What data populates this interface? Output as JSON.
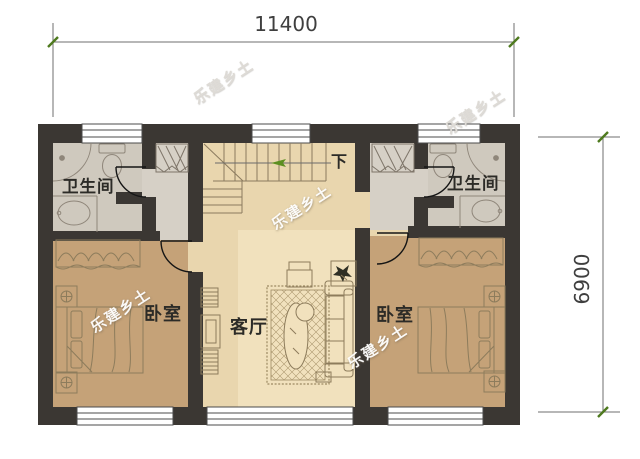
{
  "canvas": {
    "width": 640,
    "height": 459,
    "background": "#ffffff"
  },
  "dimensions": {
    "width_label": "11400",
    "height_label": "6900"
  },
  "rooms": {
    "bathroom_left": {
      "label": "卫生间"
    },
    "bathroom_right": {
      "label": "卫生间"
    },
    "bedroom_left": {
      "label": "卧室"
    },
    "bedroom_right": {
      "label": "卧室"
    },
    "living": {
      "label": "客厅"
    }
  },
  "stairs": {
    "down_label": "下"
  },
  "watermark": {
    "text": "乐建乡土"
  },
  "colors": {
    "wall": "#3b3733",
    "floor-hall": "#e9d6ae",
    "floor-living": "#f1e1bd",
    "floor-bedroom": "#c5a278",
    "floor-bath": "#cfc9be",
    "floor-vestibule": "#d6d0c6",
    "line-furniture": "#8d7c5c",
    "line-bath": "#8f867a",
    "line-dim": "#6f6f6f",
    "tick-green": "#4e7a1e",
    "arrow-green": "#5d8f21",
    "label": "#2c2b27",
    "window-line": "#4b4b4b",
    "rug-line": "#9d8a63"
  }
}
